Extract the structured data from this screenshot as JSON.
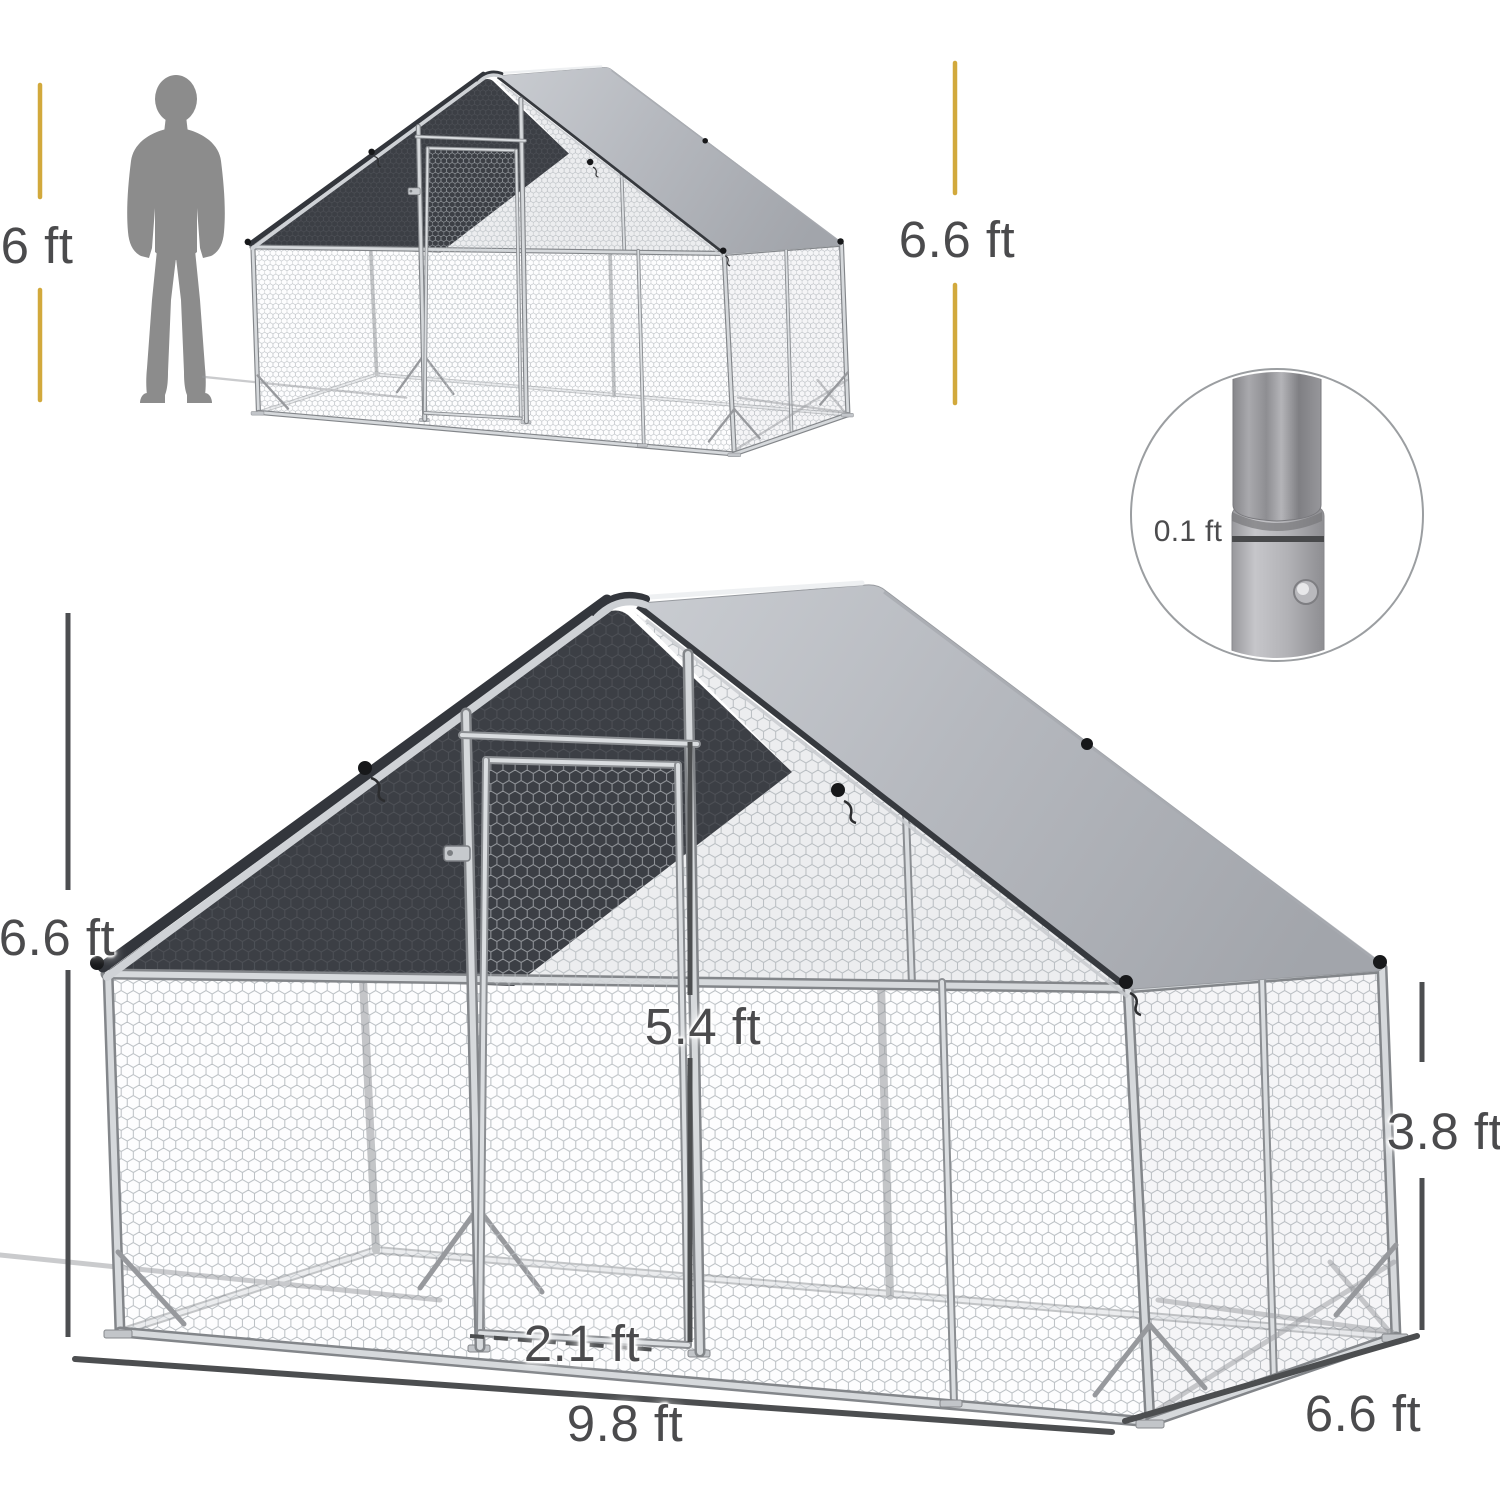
{
  "figure": {
    "human_height": "6 ft",
    "small_coop_height": "6.6 ft",
    "pole_diameter": "0.1 ft",
    "coop_ridge_height": "6.6 ft",
    "door_height": "5.4 ft",
    "door_width": "2.1 ft",
    "coop_width": "9.8 ft",
    "coop_depth": "6.6 ft",
    "wall_height": "3.8 ft"
  },
  "colors": {
    "dimension_yellow": "#d2a93c",
    "dimension_gray": "#4c4e50",
    "label_text": "#4b4b4d",
    "tarp_gray": "#b6b9bf",
    "shade_cloth_dark": "#3c3f45",
    "frame_silver": "#d6d9dc",
    "silhouette_gray": "#8c8c8c"
  }
}
